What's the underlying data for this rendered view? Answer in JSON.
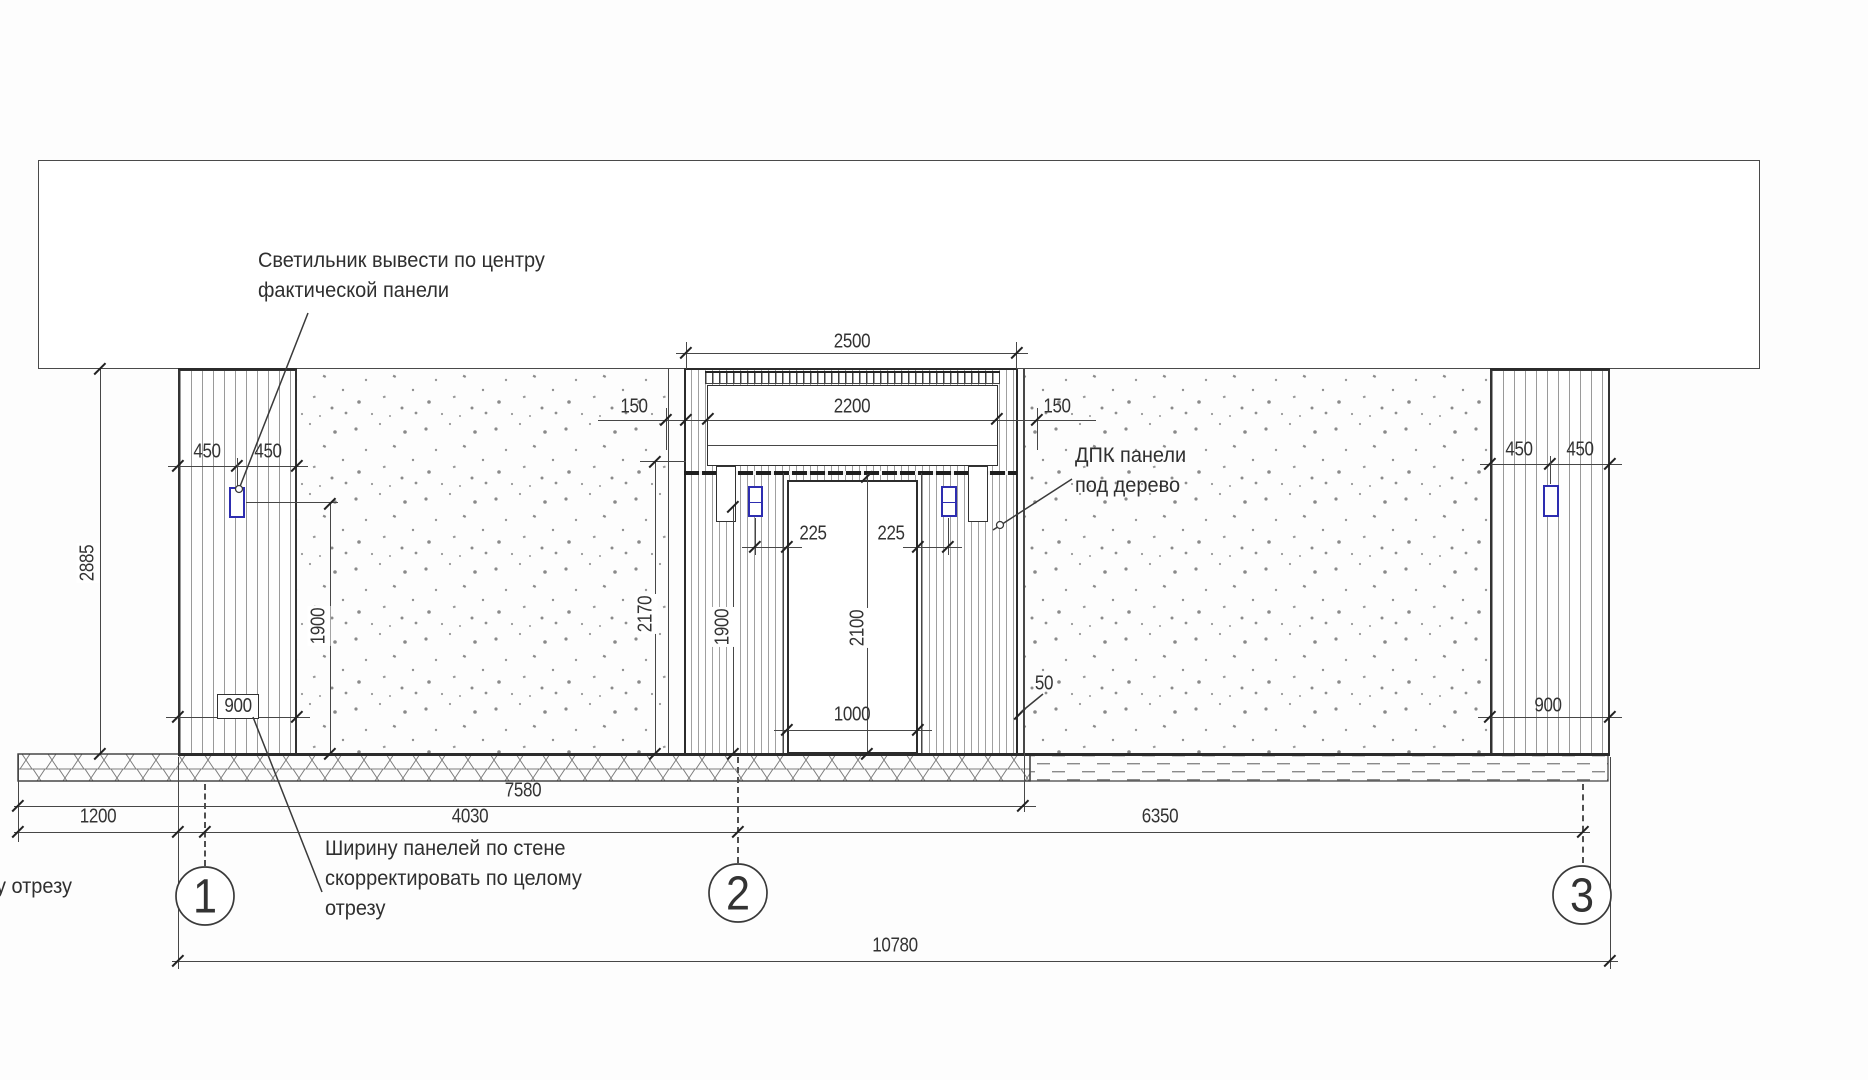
{
  "annotations": {
    "light_note_line1": "Светильник вывести по центру",
    "light_note_line2": "фактической панели",
    "dpk_note_line1": "ДПК панели",
    "dpk_note_line2": "под дерево",
    "width_note_line1": "Ширину панелей по стене",
    "width_note_line2": "скорректировать по целому",
    "width_note_line3": "отрезу",
    "left_edge_fragment": "у отрезу"
  },
  "grid_markers": {
    "m1": "1",
    "m2": "2",
    "m3": "3"
  },
  "dims": {
    "d2500": "2500",
    "d2200": "2200",
    "d150_left": "150",
    "d150_right": "150",
    "d450_left_a": "450",
    "d450_left_b": "450",
    "d450_right_a": "450",
    "d450_right_b": "450",
    "d2885": "2885",
    "d1900_left": "1900",
    "d900_left": "900",
    "d900_right": "900",
    "d2170": "2170",
    "d1900_center": "1900",
    "d2100": "2100",
    "d225_left": "225",
    "d225_right": "225",
    "d1000": "1000",
    "d50": "50",
    "d7580": "7580",
    "d1200": "1200",
    "d4030": "4030",
    "d6350": "6350",
    "d10780": "10780"
  },
  "colors": {
    "line": "#3a3a3a",
    "accent_blue": "#2d2db0",
    "stripe": "#9a9a9a",
    "speckle": "#8a8a8a",
    "background": "#fdfdfd"
  }
}
